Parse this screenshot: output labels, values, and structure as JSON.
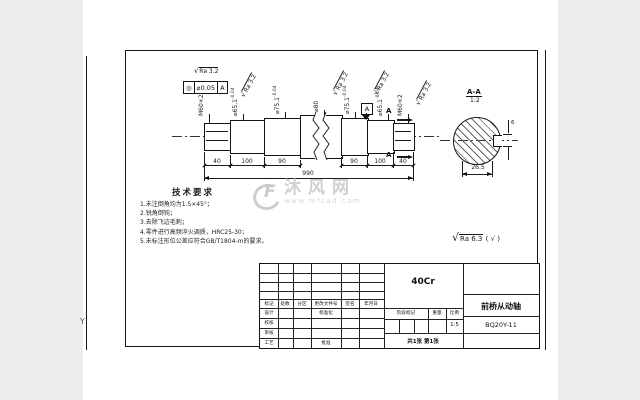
{
  "watermark": {
    "site_name": "沐风网",
    "site_url": "www.mfcad.com",
    "logo_text": "F"
  },
  "tech_requirements": {
    "title": "技术要求",
    "items": [
      "1.未注倒角均为1.5×45°；",
      "2.锐角倒钝；",
      "3.去除飞边毛刺；",
      "4.零件进行高频淬火调质，HRC25-30；",
      "5.未标注形位公差应符合GB/T1804-m的要求。"
    ]
  },
  "general_roughness": {
    "check": "√",
    "value": "Ra 6.3",
    "other": "( √ )"
  },
  "shaft": {
    "check": "√",
    "ra_mark": "Ra 3.2",
    "tol_frame": {
      "symbol": "◎",
      "value": "⌀0.05",
      "datum": "A"
    },
    "labels": [
      {
        "main": "M60×2",
        "tol": ""
      },
      {
        "main": "⌀65.1",
        "tol": "-0.04"
      },
      {
        "main": "⌀75.1",
        "tol": "-0.04"
      },
      {
        "main": "⌀80",
        "tol": ""
      },
      {
        "main": "⌀75.1",
        "tol": "-0.04"
      },
      {
        "main": "⌀65.1",
        "tol": "-0.04"
      },
      {
        "main": "M60×2",
        "tol": ""
      }
    ],
    "dims": [
      "40",
      "100",
      "90",
      "90",
      "100",
      "40"
    ],
    "overall_dim": "990",
    "datum_label": "A",
    "section_letter": "A"
  },
  "section_view": {
    "title": "A-A",
    "scale": "1:2",
    "width_dim": "26.5",
    "key_dim": "6"
  },
  "title_block": {
    "material": "40Cr",
    "part_name": "前桥从动轴",
    "drawing_no": "BQ20Y-11",
    "header_cols": [
      "标记",
      "处数",
      "分区",
      "更改文件号",
      "签名",
      "年月日"
    ],
    "row_labels": [
      "设计",
      "校核",
      "审核",
      "工艺"
    ],
    "mid_labels": {
      "standardization": "标准化",
      "approve": "批准"
    },
    "stage_cols": [
      "阶段标记",
      "重量",
      "比例"
    ],
    "scale_value": "1:5",
    "sheet_info": "共1张  第1张"
  },
  "frame": {
    "centering_mark": "Y"
  }
}
